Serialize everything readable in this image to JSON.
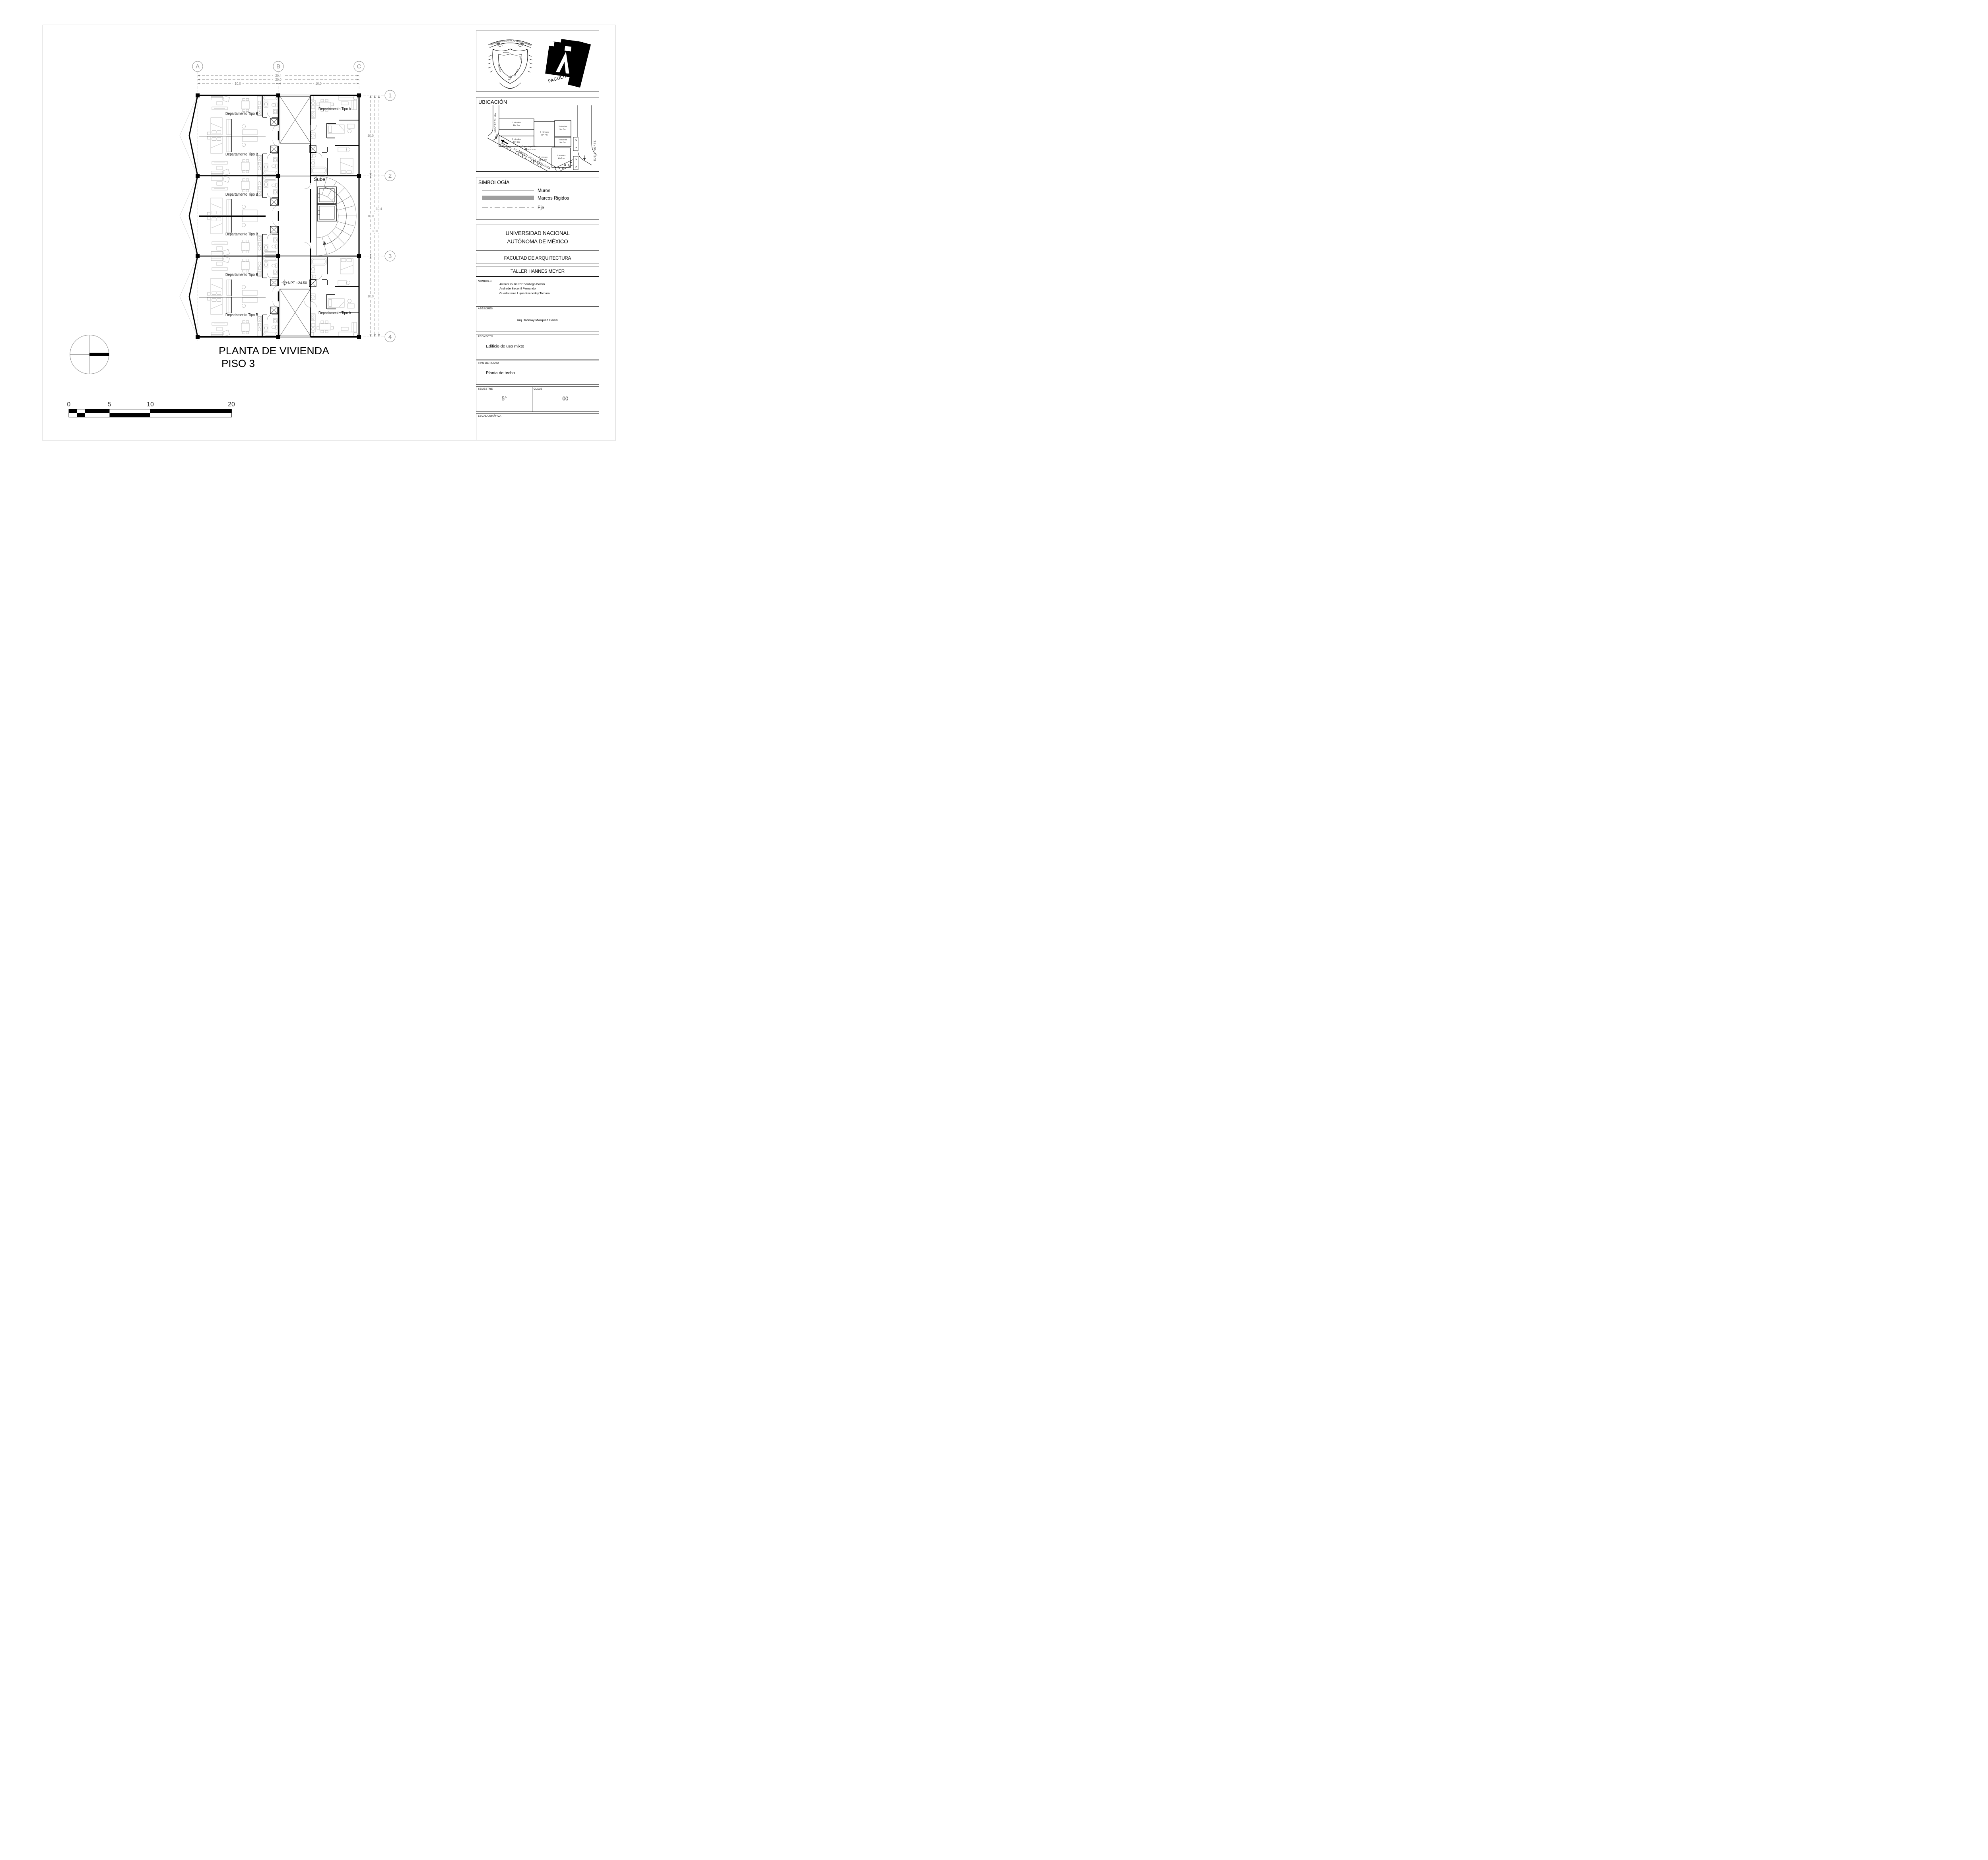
{
  "sheet": {
    "title_line1": "PLANTA DE VIVIENDA",
    "title_line2": "PISO 3"
  },
  "plan": {
    "grid_cols": [
      "A",
      "B",
      "C"
    ],
    "grid_rows": [
      "1",
      "2",
      "3",
      "4"
    ],
    "dims_top": {
      "overall": "20.4",
      "inner": "20.0",
      "left_bay": "10.0",
      "right_bay": "10.0"
    },
    "dims_right": {
      "bay1": "10.0",
      "bay2": "10.0",
      "bay3": "10.0",
      "inner_total": "30.0",
      "overall": "30.4"
    },
    "units": {
      "b1": "Departamento Tipo B",
      "b2": "Departamento Tipo B",
      "b3": "Departamento Tipo B",
      "b4": "Departamento Tipo B",
      "b5": "Departamento Tipo B",
      "b6": "Departamento Tipo B",
      "a1": "Departamento Tipo A",
      "a2": "Departamento Tipo A"
    },
    "stair_label": "Sube",
    "level_label": "NPT +24.50"
  },
  "scalebar": {
    "labels": [
      "0",
      "5",
      "10",
      "20"
    ]
  },
  "logos": {
    "unam_banner": "UNIVERSIDAD NACIONAL AUTONOMA D MEXICO",
    "motto_words": [
      "POR MI",
      "RAZA",
      "HABLARA",
      "EL",
      "ESPIRITV"
    ],
    "facultad": "FACULTAD",
    "arquitectura": "ARQUITECTURA"
  },
  "ubicacion": {
    "title": "UBICACIÓN",
    "streets": {
      "left": "MOCTEZUMA",
      "avenue": "AV. PASEO DE  LA REFORMA",
      "right": "EJE 1 NORTE"
    },
    "buildings": [
      {
        "line1": "2 niveles",
        "line2": "H= 5m"
      },
      {
        "line1": "2 niveles",
        "line2": "H= 5m"
      },
      {
        "line1": "3 niveles",
        "line2": "H= 7m"
      },
      {
        "line1": "3 niveles",
        "line2": "H= 8m"
      },
      {
        "line1": "3 niveles",
        "line2": "H= 8m"
      },
      {
        "line1": "2 niveles",
        "line2": "H=6 m"
      },
      {
        "line1": "2 niveles",
        "line2": "H=7.5m"
      }
    ],
    "space": "Espacio público",
    "benchmark": "B.N. ±0.00"
  },
  "simbologia": {
    "title": "SIMBOLOGÍA",
    "items": [
      "Muros",
      "Marcos Rigidos",
      "Eje"
    ]
  },
  "titleblock": {
    "university_line1": "UNIVERSIDAD NACIONAL",
    "university_line2": "AUTÓNOMA DE MÉXICO",
    "faculty": "FACULTAD DE ARQUITECTURA",
    "workshop": "TALLER HANNES MEYER",
    "nombres_label": "NOMBRES",
    "nombres": [
      "Alvarez Gutierrez Santiago Balam",
      "Andrade Becerril Fernando",
      "Guadarrama Luján Kimberley Tamara"
    ],
    "asesores_label": "ASESORES",
    "asesores": "Arq. Monroy Márquez Daniel",
    "proyecto_label": "PROYECTO",
    "proyecto": "Edificio de uso mixto",
    "tipo_label": "TIPO DE PLANO",
    "tipo": "Planta de techo",
    "semestre_label": "SEMESTRE",
    "semestre": "5°",
    "clave_label": "CLAVE",
    "clave": "00",
    "escala_label": "ESCALA GRÁFICA"
  },
  "colors": {
    "wall": "#000000",
    "furniture": "#b3b3b3",
    "dims": "#8a8a8a",
    "marcos_rigidos": "#9e9e9e"
  }
}
